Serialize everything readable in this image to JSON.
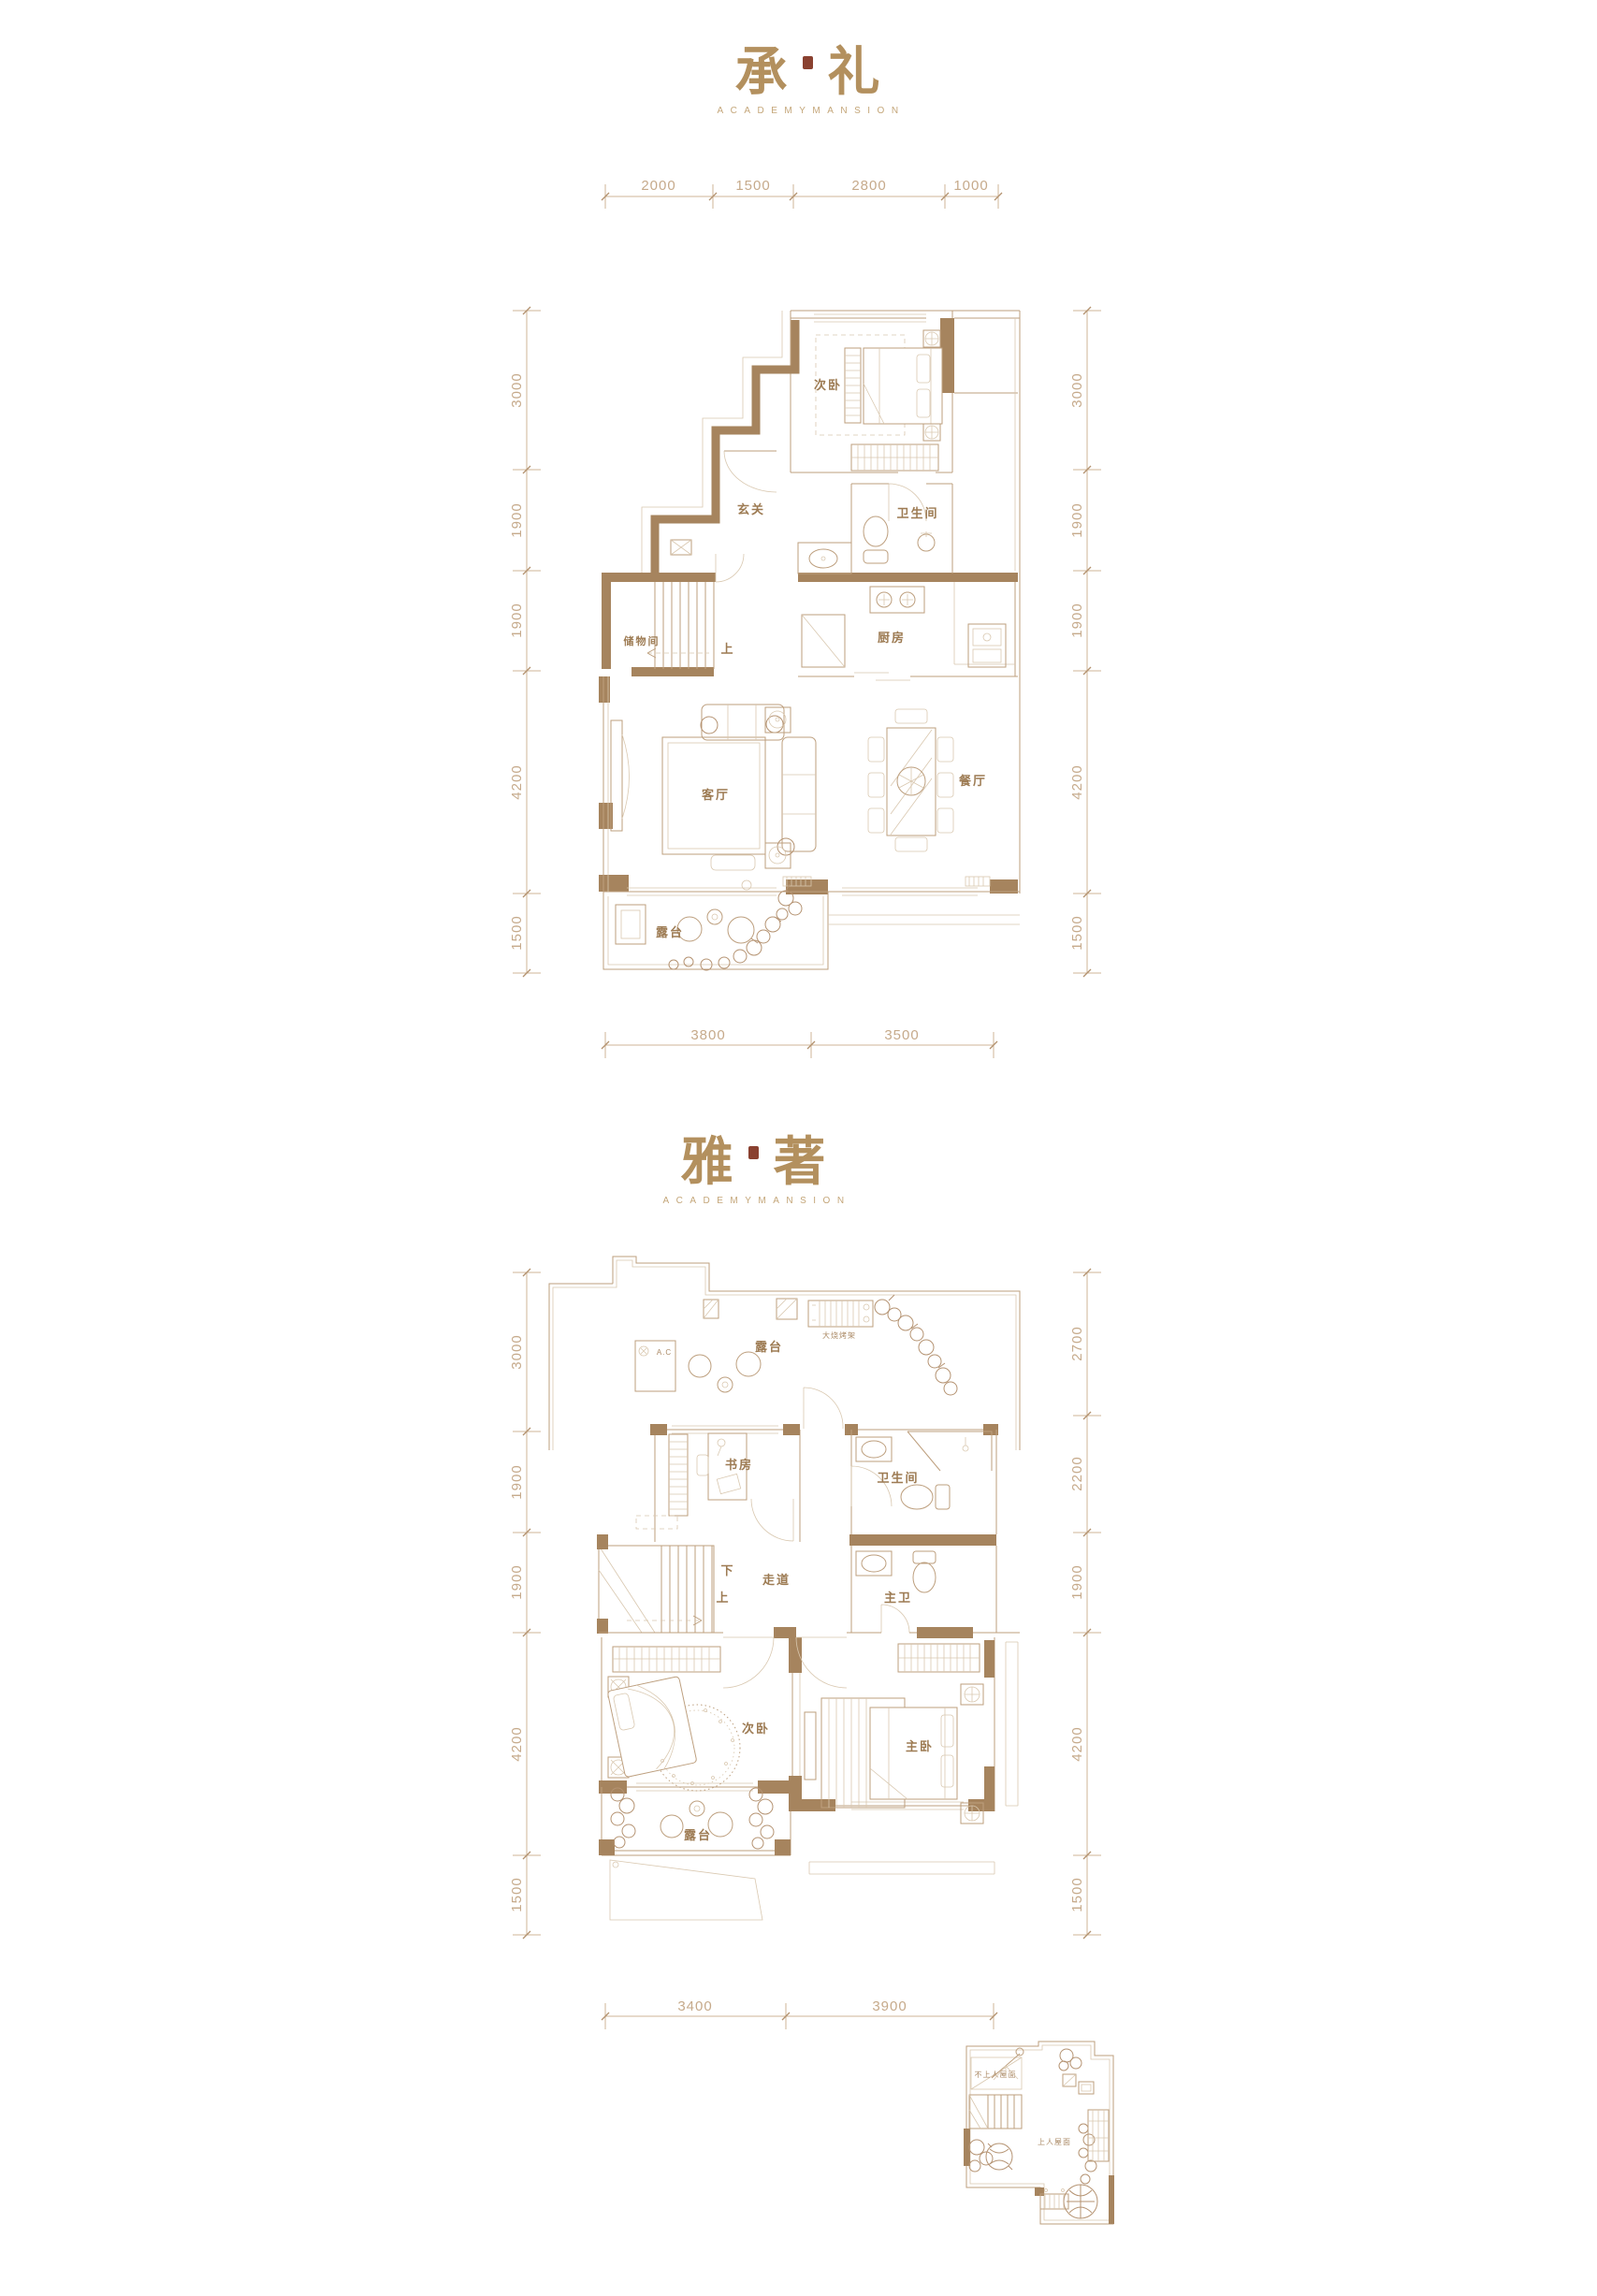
{
  "colors": {
    "wall": "#a6845e",
    "thin_line": "#bd9f7e",
    "dim_line": "#cfb497",
    "dim_text": "#c6aa8b",
    "room_label": "#9d7b53",
    "title": "#b3905e",
    "subtitle": "#c4a679",
    "seal": "#8a4130",
    "background": "#ffffff"
  },
  "plan1": {
    "title": {
      "char1": "承",
      "char2": "礼",
      "subtitle": "ACADEMYMANSION"
    },
    "dims_top": [
      "2000",
      "1500",
      "2800",
      "1000"
    ],
    "dims_left": [
      "3000",
      "1900",
      "1900",
      "4200",
      "1500"
    ],
    "dims_right": [
      "3000",
      "1900",
      "1900",
      "4200",
      "1500"
    ],
    "dims_bottom": [
      "3800",
      "3500"
    ],
    "rooms": {
      "bedroom2": "次卧",
      "foyer": "玄关",
      "bathroom": "卫生间",
      "storage": "储物间",
      "up": "上",
      "kitchen": "厨房",
      "living": "客厅",
      "dining": "餐厅",
      "terrace": "露台"
    }
  },
  "plan2": {
    "title": {
      "char1": "雅",
      "char2": "著",
      "subtitle": "ACADEMYMANSION"
    },
    "dims_left": [
      "3000",
      "1900",
      "1900",
      "4200",
      "1500"
    ],
    "dims_right": [
      "2700",
      "2200",
      "1900",
      "4200",
      "1500"
    ],
    "dims_bottom": [
      "3400",
      "3900"
    ],
    "rooms": {
      "terrace_top": "露台",
      "ac": "A.C",
      "bbq": "大烧烤架",
      "study": "书房",
      "bathroom": "卫生间",
      "down": "下",
      "up": "上",
      "corridor": "走道",
      "master_bath": "主卫",
      "bedroom2": "次卧",
      "master": "主卧",
      "terrace_bottom": "露台"
    }
  },
  "inset": {
    "roof_no_access": "不上人屋面",
    "roof_access": "上人屋面"
  }
}
